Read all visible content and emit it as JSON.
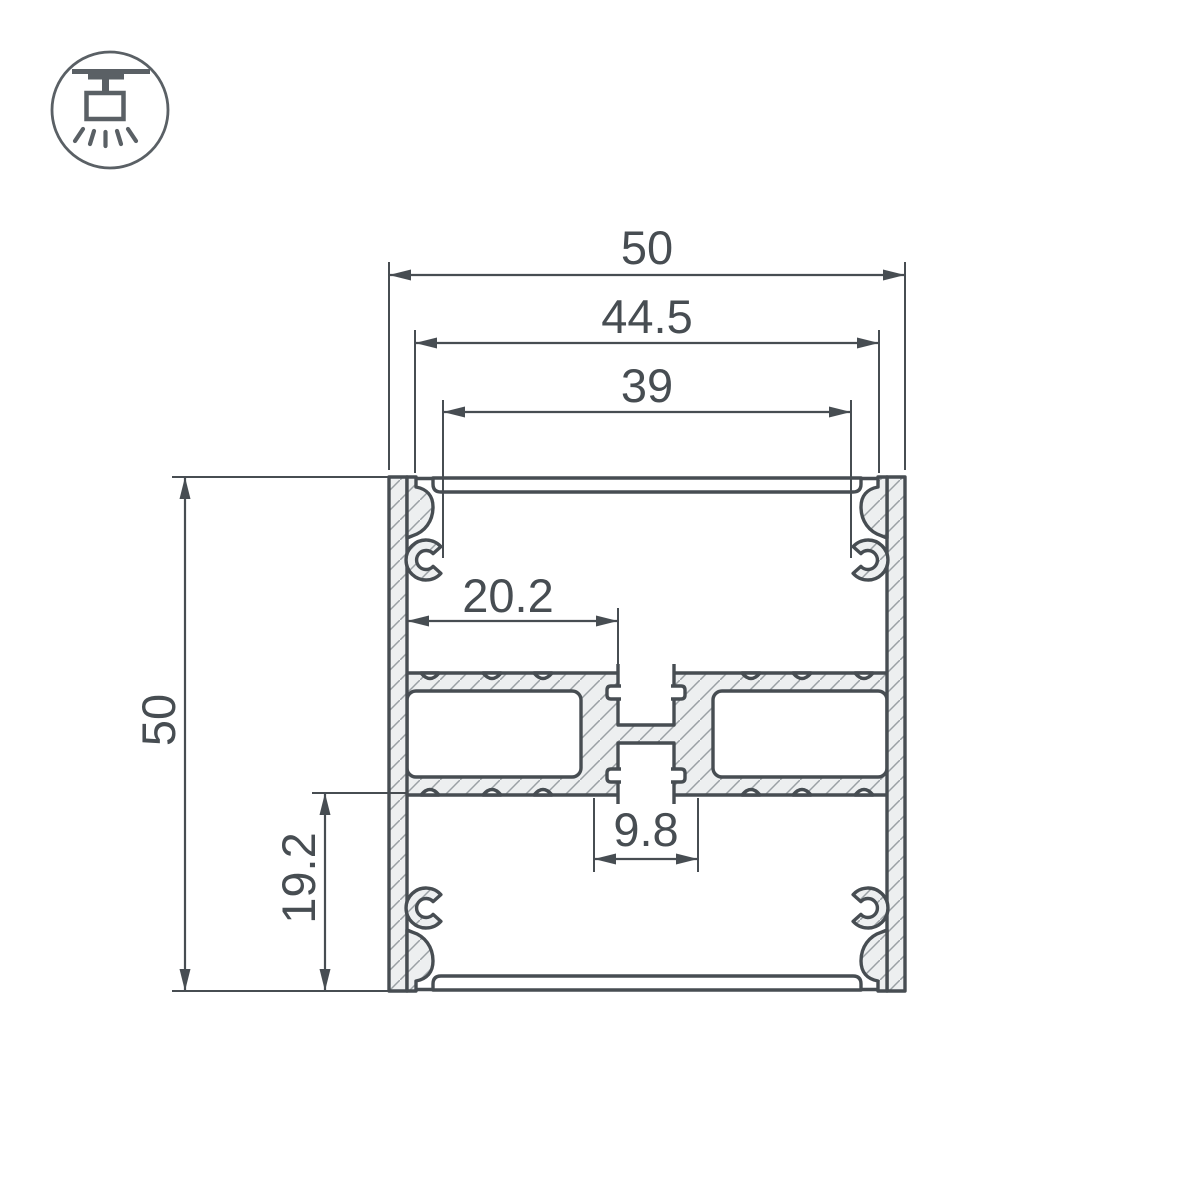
{
  "icon": {
    "name": "surface-ceiling-light-icon"
  },
  "dimensions": {
    "outer_width": "50",
    "diffuser_seat_width": "44.5",
    "inner_opening_width": "39",
    "outer_height": "50",
    "bottom_chamber_height": "19.2",
    "wall_to_center_rib_width": "20.2",
    "center_channel_width": "9.8"
  },
  "colors": {
    "line": "#474d52",
    "hatch_fill": "#edeff0",
    "hatch_line": "#9aa0a4",
    "icon_line": "#5a6065",
    "background": "#ffffff"
  }
}
